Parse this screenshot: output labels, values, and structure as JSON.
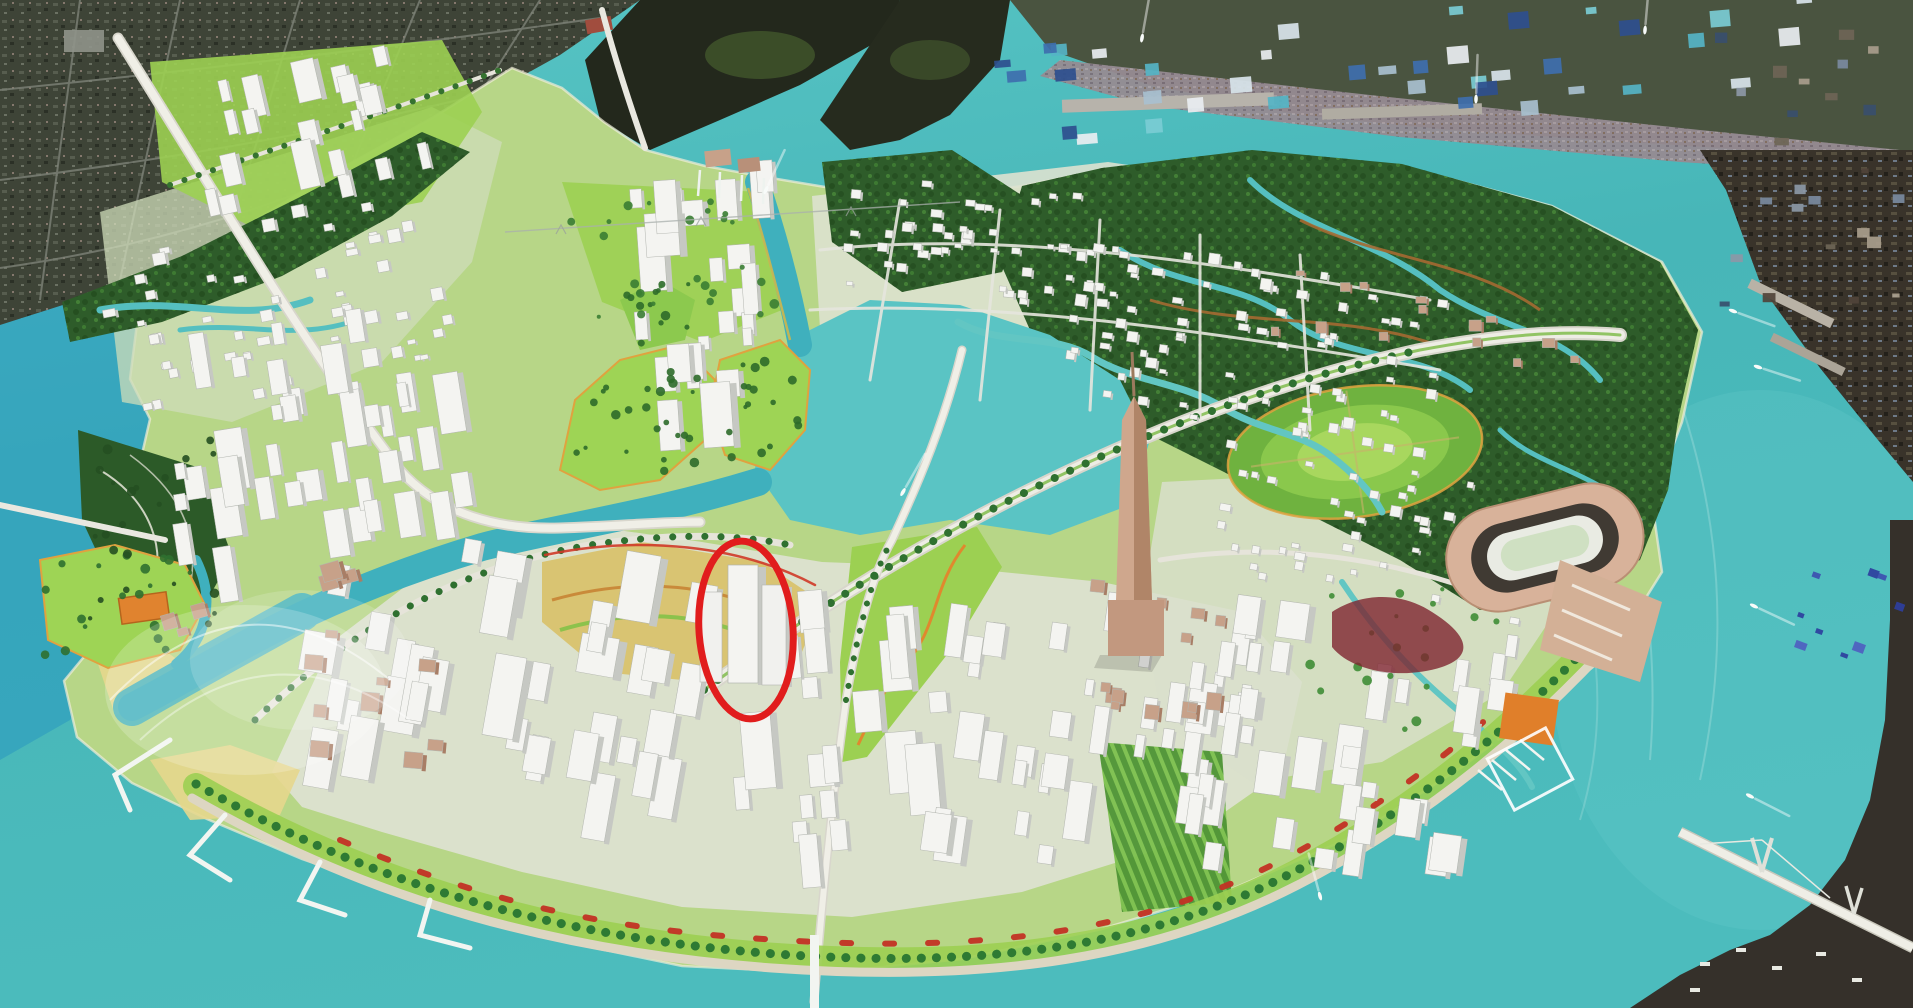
{
  "scene": {
    "description": "Bird's-eye 3D masterplan rendering of a river-loop peninsula new-town (Thu Thiem style). Rendered white model districts sit inside a teal river bend, bordered by satellite photo of the existing city and industrial port. A red ellipse annotation circles one highrise tower in the southern crescent district.",
    "annotation": {
      "shape": "ellipse",
      "cx": 746,
      "cy": 630,
      "rx": 47,
      "ry": 89,
      "rotation": -4,
      "color": "#e11d1d",
      "stroke_width": 7,
      "target": "highlighted-tower-block"
    },
    "regions": [
      {
        "id": "river-water",
        "label": "teal river loop"
      },
      {
        "id": "existing-city-satellite",
        "label": "satellite photo, existing city (top-left)"
      },
      {
        "id": "industrial-port-satellite",
        "label": "satellite photo, industrial port (top and right edge)"
      },
      {
        "id": "mangrove-forest",
        "label": "dark green mangrove wetland"
      },
      {
        "id": "north-residential",
        "label": "white slab housing cluster"
      },
      {
        "id": "west-towers",
        "label": "western tower district"
      },
      {
        "id": "central-grid",
        "label": "central low-rise grid district"
      },
      {
        "id": "crescent-cbd",
        "label": "southern crescent highrise district"
      },
      {
        "id": "landmark-tower",
        "label": "tall tan landmark tower"
      },
      {
        "id": "stadium",
        "label": "oval stadium"
      },
      {
        "id": "round-terraced-park",
        "label": "circular terraced park"
      },
      {
        "id": "central-lake",
        "label": "central lake and channels"
      },
      {
        "id": "waterfront-promenade",
        "label": "curved waterfront promenade with red pavilions"
      },
      {
        "id": "cable-bridge",
        "label": "cable-stayed bridge (bottom right)"
      },
      {
        "id": "boats",
        "label": "small boats with white wakes"
      }
    ],
    "clusters": [
      {
        "id": "north-residential",
        "style": "tower",
        "x": 185,
        "y": 62,
        "w": 230,
        "h": 120,
        "angle": -13,
        "count": 20,
        "min": 9,
        "max": 22
      },
      {
        "id": "northwest-blocks",
        "style": "block",
        "x": 100,
        "y": 212,
        "w": 340,
        "h": 185,
        "angle": -11,
        "count": 55,
        "min": 7,
        "max": 13
      },
      {
        "id": "west-towers",
        "style": "tower",
        "x": 158,
        "y": 308,
        "w": 300,
        "h": 235,
        "angle": -9,
        "count": 40,
        "min": 11,
        "max": 26
      },
      {
        "id": "north-central-towers",
        "style": "tower",
        "x": 632,
        "y": 158,
        "w": 145,
        "h": 245,
        "angle": -4,
        "count": 26,
        "min": 10,
        "max": 28
      },
      {
        "id": "grid-a",
        "style": "block",
        "x": 845,
        "y": 182,
        "w": 275,
        "h": 112,
        "angle": 5,
        "count": 48,
        "min": 6,
        "max": 11
      },
      {
        "id": "grid-b",
        "style": "block",
        "x": 1065,
        "y": 252,
        "w": 370,
        "h": 175,
        "angle": 8,
        "count": 80,
        "min": 6,
        "max": 11
      },
      {
        "id": "crescent-west",
        "style": "tower",
        "x": 305,
        "y": 525,
        "w": 385,
        "h": 240,
        "angle": 10,
        "count": 36,
        "min": 13,
        "max": 34
      },
      {
        "id": "crescent-mid",
        "style": "tower",
        "x": 718,
        "y": 588,
        "w": 225,
        "h": 250,
        "angle": -5,
        "count": 20,
        "min": 12,
        "max": 32
      },
      {
        "id": "south-central",
        "style": "tower",
        "x": 935,
        "y": 588,
        "w": 300,
        "h": 280,
        "angle": 8,
        "count": 42,
        "min": 9,
        "max": 24
      },
      {
        "id": "east-towers",
        "style": "tower",
        "x": 1185,
        "y": 605,
        "w": 310,
        "h": 245,
        "angle": 8,
        "count": 34,
        "min": 10,
        "max": 26
      },
      {
        "id": "east-villages",
        "style": "block",
        "x": 1205,
        "y": 462,
        "w": 320,
        "h": 130,
        "angle": 10,
        "count": 40,
        "min": 6,
        "max": 11
      },
      {
        "id": "tan-civic",
        "style": "tan",
        "x": 1060,
        "y": 585,
        "w": 220,
        "h": 130,
        "angle": 6,
        "count": 14,
        "min": 8,
        "max": 17
      },
      {
        "id": "sw-waterfront",
        "style": "tan",
        "x": 150,
        "y": 548,
        "w": 195,
        "h": 70,
        "angle": -16,
        "count": 7,
        "min": 10,
        "max": 20
      },
      {
        "id": "sw-cultural",
        "style": "tan",
        "x": 272,
        "y": 628,
        "w": 165,
        "h": 125,
        "angle": 5,
        "count": 9,
        "min": 11,
        "max": 22
      },
      {
        "id": "ne-hamlet-1",
        "style": "tan",
        "x": 1262,
        "y": 268,
        "w": 165,
        "h": 65,
        "angle": 0,
        "count": 8,
        "min": 7,
        "max": 13
      },
      {
        "id": "ne-hamlet-2",
        "style": "tan",
        "x": 1452,
        "y": 300,
        "w": 135,
        "h": 65,
        "angle": 0,
        "count": 6,
        "min": 7,
        "max": 13
      },
      {
        "id": "industrial-roofs",
        "style": "roof",
        "x": 985,
        "y": 10,
        "w": 860,
        "h": 105,
        "angle": -5,
        "count": 40,
        "min": 10,
        "max": 22,
        "colors": [
          "#3e6fae",
          "#79ccd4",
          "#e9eef1",
          "#2e4f8e",
          "#55b4c6",
          "#a8c0cf",
          "#d8e4ea"
        ]
      },
      {
        "id": "port-roofs",
        "style": "roof",
        "x": 1708,
        "y": 28,
        "w": 190,
        "h": 290,
        "angle": 0,
        "count": 26,
        "min": 7,
        "max": 16,
        "colors": [
          "#6e6556",
          "#8c98a6",
          "#384f6d",
          "#a89d8c",
          "#50433a",
          "#7a8aa0"
        ]
      },
      {
        "id": "br-containers",
        "style": "roof",
        "x": 1802,
        "y": 548,
        "w": 95,
        "h": 115,
        "angle": 20,
        "count": 9,
        "min": 6,
        "max": 12,
        "colors": [
          "#3d4fb0",
          "#4f5fc0",
          "#2e3f9e"
        ]
      },
      {
        "id": "island-1-trees",
        "style": "trees",
        "x": 572,
        "y": 362,
        "w": 128,
        "h": 115,
        "count": 24,
        "color": "#2e6b2a"
      },
      {
        "id": "island-2-trees",
        "style": "trees",
        "x": 722,
        "y": 352,
        "w": 82,
        "h": 110,
        "count": 16,
        "color": "#2e6b2a"
      },
      {
        "id": "island-3-trees",
        "style": "trees",
        "x": 622,
        "y": 282,
        "w": 70,
        "h": 62,
        "count": 12,
        "color": "#2e6b2a"
      },
      {
        "id": "left-island-trees",
        "style": "trees",
        "x": 42,
        "y": 552,
        "w": 155,
        "h": 110,
        "count": 18,
        "color": "#2f7030"
      },
      {
        "id": "marina-park-trees",
        "style": "trees",
        "x": 560,
        "y": 195,
        "w": 220,
        "h": 130,
        "count": 26,
        "color": "#3a7d33"
      },
      {
        "id": "west-forest-trees",
        "style": "trees",
        "x": 85,
        "y": 435,
        "w": 130,
        "h": 190,
        "count": 22,
        "color": "#254f21"
      },
      {
        "id": "east-park-trees",
        "style": "trees",
        "x": 1300,
        "y": 580,
        "w": 200,
        "h": 150,
        "count": 20,
        "color": "#3f8d36"
      }
    ],
    "boats": [
      {
        "x": 766,
        "y": 190,
        "heading": 115
      },
      {
        "x": 1142,
        "y": 38,
        "heading": 100
      },
      {
        "x": 1645,
        "y": 30,
        "heading": 95
      },
      {
        "x": 1733,
        "y": 311,
        "heading": 200
      },
      {
        "x": 1758,
        "y": 367,
        "heading": 198
      },
      {
        "x": 1754,
        "y": 606,
        "heading": 205
      },
      {
        "x": 1750,
        "y": 796,
        "heading": 207
      },
      {
        "x": 1320,
        "y": 896,
        "heading": 75
      },
      {
        "x": 1476,
        "y": 99,
        "heading": 92
      },
      {
        "x": 903,
        "y": 492,
        "heading": 120
      }
    ]
  },
  "palette": {
    "water": "#47b6b8",
    "water_light": "#5ac4c4",
    "water_channel": "#3fb0bd",
    "water_blue_west": "#2291c2",
    "lawn_base": "#b7d687",
    "lawn_bright": "#9cd052",
    "mangrove": "#2e5c2a",
    "building_top": "#f4f4f1",
    "building_side": "#c6c8c3",
    "building_edge": "#b2b5af",
    "tan_building": "#c7a189",
    "tan_side": "#a87e66",
    "sand": "#e6d78d",
    "orange_edge": "#e0882e",
    "red_accent": "#c23124",
    "road": "#eeede5",
    "road_edge": "#d8d6cc",
    "sat_urban": "#3e4437",
    "sat_port": "#39332a",
    "annotation_red": "#e11d1d",
    "pier_white": "#f2f5f1"
  }
}
